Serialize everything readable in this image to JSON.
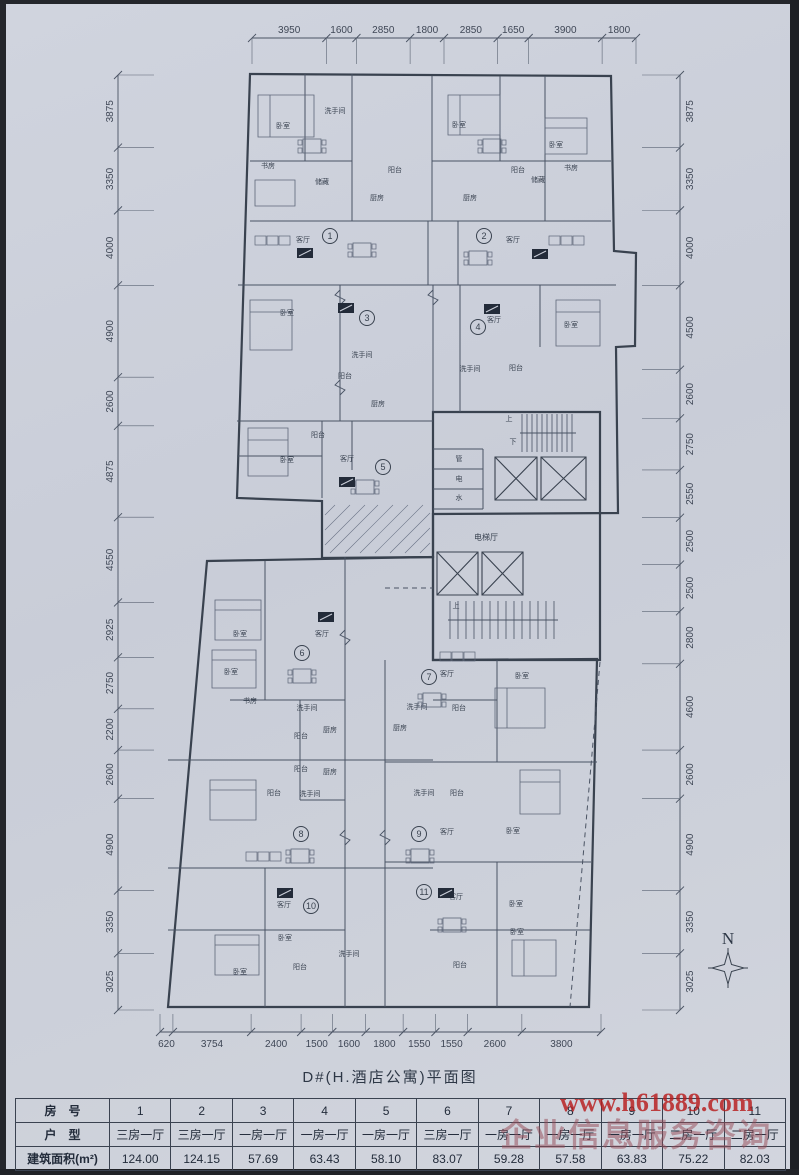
{
  "page": {
    "title": "D#(H.酒店公寓)平面图",
    "compass_label": "N",
    "watermark": {
      "line1": "www.h61889.com",
      "line2": "企业信息服务咨询",
      "color": "#b71c1c"
    }
  },
  "plan": {
    "dimensions": {
      "top": [
        3950,
        1600,
        2850,
        1800,
        2850,
        1650,
        3900,
        1800
      ],
      "bottom": [
        620,
        3754,
        2400,
        1500,
        1600,
        1800,
        1550,
        1550,
        2600,
        3800
      ],
      "left": [
        3875,
        3350,
        4000,
        4900,
        2600,
        4875,
        4550,
        2925,
        2750,
        2200,
        2600,
        4900,
        3350,
        3025
      ],
      "right": [
        3875,
        3350,
        4000,
        4500,
        2600,
        2750,
        2550,
        2500,
        2500,
        2800,
        4600,
        2600,
        4900,
        3350,
        3025
      ]
    },
    "units": [
      {
        "n": "1",
        "x": 330,
        "y": 236
      },
      {
        "n": "2",
        "x": 484,
        "y": 236
      },
      {
        "n": "3",
        "x": 367,
        "y": 318
      },
      {
        "n": "4",
        "x": 478,
        "y": 327
      },
      {
        "n": "5",
        "x": 383,
        "y": 467
      },
      {
        "n": "6",
        "x": 302,
        "y": 653
      },
      {
        "n": "7",
        "x": 429,
        "y": 677
      },
      {
        "n": "8",
        "x": 301,
        "y": 834
      },
      {
        "n": "9",
        "x": 419,
        "y": 834
      },
      {
        "n": "10",
        "x": 311,
        "y": 906
      },
      {
        "n": "11",
        "x": 424,
        "y": 892
      }
    ],
    "room_labels": [
      {
        "t": "卧室",
        "x": 283,
        "y": 128
      },
      {
        "t": "洗手间",
        "x": 335,
        "y": 113
      },
      {
        "t": "卧室",
        "x": 459,
        "y": 127
      },
      {
        "t": "卧室",
        "x": 556,
        "y": 147
      },
      {
        "t": "书房",
        "x": 268,
        "y": 168
      },
      {
        "t": "储藏",
        "x": 322,
        "y": 184
      },
      {
        "t": "储藏",
        "x": 538,
        "y": 182
      },
      {
        "t": "书房",
        "x": 571,
        "y": 170
      },
      {
        "t": "阳台",
        "x": 395,
        "y": 172
      },
      {
        "t": "阳台",
        "x": 518,
        "y": 172
      },
      {
        "t": "厨房",
        "x": 377,
        "y": 200
      },
      {
        "t": "厨房",
        "x": 470,
        "y": 200
      },
      {
        "t": "客厅",
        "x": 303,
        "y": 242
      },
      {
        "t": "客厅",
        "x": 513,
        "y": 242
      },
      {
        "t": "卧室",
        "x": 287,
        "y": 315
      },
      {
        "t": "客厅",
        "x": 494,
        "y": 322
      },
      {
        "t": "卧室",
        "x": 571,
        "y": 327
      },
      {
        "t": "洗手间",
        "x": 362,
        "y": 357
      },
      {
        "t": "洗手间",
        "x": 470,
        "y": 371
      },
      {
        "t": "阳台",
        "x": 516,
        "y": 370
      },
      {
        "t": "阳台",
        "x": 345,
        "y": 378
      },
      {
        "t": "厨房",
        "x": 378,
        "y": 406
      },
      {
        "t": "阳台",
        "x": 318,
        "y": 437
      },
      {
        "t": "卧室",
        "x": 287,
        "y": 462
      },
      {
        "t": "客厅",
        "x": 347,
        "y": 461
      },
      {
        "t": "上",
        "x": 509,
        "y": 421
      },
      {
        "t": "下",
        "x": 513,
        "y": 444
      },
      {
        "t": "管",
        "x": 459,
        "y": 461
      },
      {
        "t": "电",
        "x": 459,
        "y": 481
      },
      {
        "t": "水",
        "x": 459,
        "y": 500
      },
      {
        "t": "电梯厅",
        "x": 486,
        "y": 540
      },
      {
        "t": "上",
        "x": 456,
        "y": 608
      },
      {
        "t": "卧室",
        "x": 240,
        "y": 636
      },
      {
        "t": "卧室",
        "x": 231,
        "y": 674
      },
      {
        "t": "客厅",
        "x": 322,
        "y": 636
      },
      {
        "t": "书房",
        "x": 250,
        "y": 703
      },
      {
        "t": "洗手间",
        "x": 307,
        "y": 710
      },
      {
        "t": "阳台",
        "x": 301,
        "y": 738
      },
      {
        "t": "厨房",
        "x": 330,
        "y": 732
      },
      {
        "t": "阳台",
        "x": 301,
        "y": 771
      },
      {
        "t": "厨房",
        "x": 330,
        "y": 774
      },
      {
        "t": "洗手间",
        "x": 310,
        "y": 796
      },
      {
        "t": "客厅",
        "x": 447,
        "y": 676
      },
      {
        "t": "卧室",
        "x": 522,
        "y": 678
      },
      {
        "t": "洗手间",
        "x": 417,
        "y": 709
      },
      {
        "t": "阳台",
        "x": 459,
        "y": 710
      },
      {
        "t": "厨房",
        "x": 400,
        "y": 730
      },
      {
        "t": "阳台",
        "x": 274,
        "y": 795
      },
      {
        "t": "洗手间",
        "x": 424,
        "y": 795
      },
      {
        "t": "阳台",
        "x": 457,
        "y": 795
      },
      {
        "t": "客厅",
        "x": 447,
        "y": 834
      },
      {
        "t": "卧室",
        "x": 513,
        "y": 833
      },
      {
        "t": "客厅",
        "x": 284,
        "y": 907
      },
      {
        "t": "卧室",
        "x": 285,
        "y": 940
      },
      {
        "t": "客厅",
        "x": 456,
        "y": 899
      },
      {
        "t": "卧室",
        "x": 516,
        "y": 906
      },
      {
        "t": "卧室",
        "x": 517,
        "y": 934
      },
      {
        "t": "阳台",
        "x": 300,
        "y": 969
      },
      {
        "t": "洗手间",
        "x": 349,
        "y": 956
      },
      {
        "t": "卧室",
        "x": 240,
        "y": 974
      },
      {
        "t": "阳台",
        "x": 460,
        "y": 967
      }
    ]
  },
  "table": {
    "rows": [
      {
        "header": "房　号",
        "cells": [
          "1",
          "2",
          "3",
          "4",
          "5",
          "6",
          "7",
          "8",
          "9",
          "10",
          "11"
        ]
      },
      {
        "header": "户　型",
        "cells": [
          "三房一厅",
          "三房一厅",
          "一房一厅",
          "一房一厅",
          "一房一厅",
          "三房一厅",
          "一房一厅",
          "一房一厅",
          "一房一厅",
          "二房一厅",
          "二房一厅"
        ]
      },
      {
        "header": "建筑面积(m²)",
        "cells": [
          "124.00",
          "124.15",
          "57.69",
          "63.43",
          "58.10",
          "83.07",
          "59.28",
          "57.58",
          "63.83",
          "75.22",
          "82.03"
        ]
      }
    ]
  }
}
